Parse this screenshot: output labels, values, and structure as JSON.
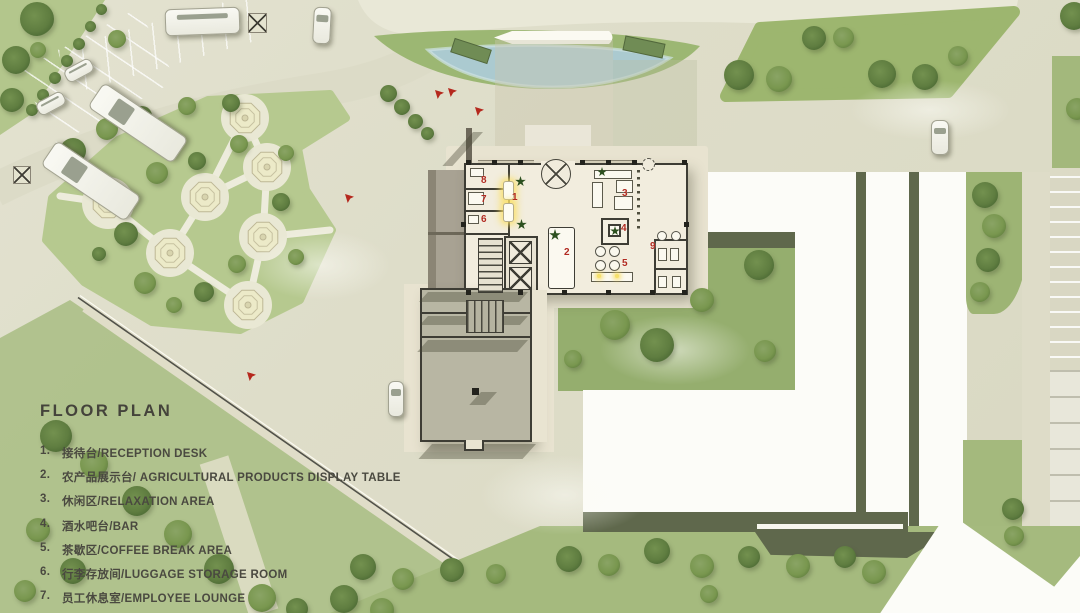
{
  "title": "FLOOR  PLAN",
  "legend": {
    "items": [
      {
        "num": "1.",
        "text": "接待台/RECEPTION DESK"
      },
      {
        "num": "2.",
        "text": "农产品展示台/ AGRICULTURAL PRODUCTS DISPLAY TABLE"
      },
      {
        "num": "3.",
        "text": "休闲区/RELAXATION AREA"
      },
      {
        "num": "4.",
        "text": "酒水吧台/BAR"
      },
      {
        "num": "5.",
        "text": "茶歇区/COFFEE BREAK AREA"
      },
      {
        "num": "6.",
        "text": "行李存放间/LUGGAGE STORAGE ROOM"
      },
      {
        "num": "7.",
        "text": "员工休息室/EMPLOYEE LOUNGE"
      },
      {
        "num": "8.",
        "text": "控制室/CONTROL ROOM"
      }
    ]
  },
  "plan": {
    "markers": [
      "1",
      "2",
      "3",
      "4",
      "5",
      "6",
      "7",
      "8",
      "9"
    ]
  },
  "colors": {
    "marker_red": "#b12a20",
    "water_blue": "#abcad0",
    "lawn_green": "#a8bd82",
    "roof_white": "#fcfcf8",
    "shadow_olive": "#5f684c",
    "floor_cream": "#f2edde",
    "wall_dark": "#3e3d35",
    "legend_text": "#4a4940"
  }
}
